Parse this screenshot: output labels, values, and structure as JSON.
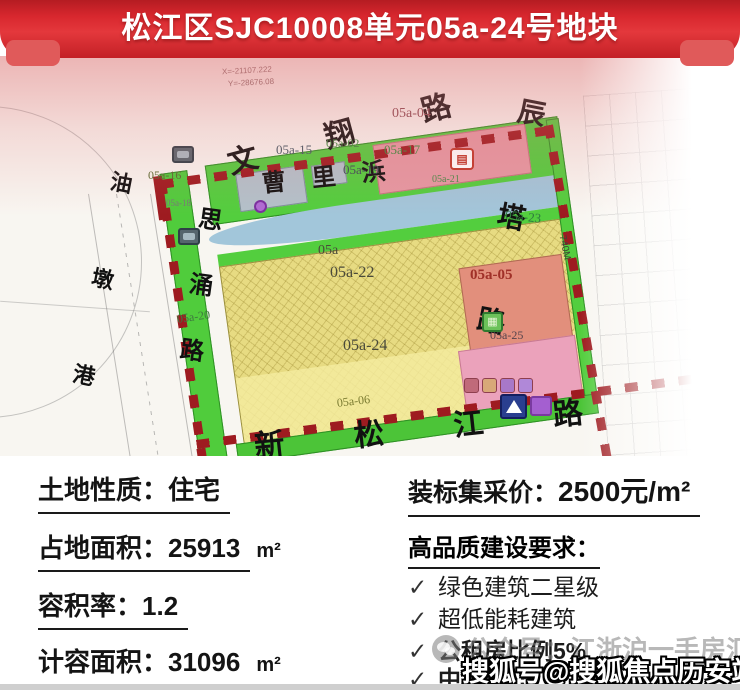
{
  "header": {
    "title": "松江区SJC10008单元05a-24号地块"
  },
  "map": {
    "roads": {
      "top": "文翔路",
      "right": "辰塔路",
      "bottom": "新松江路",
      "left_road": "思涌路"
    },
    "waterways": {
      "left_river": "油墩港",
      "mid_river": "曹里浜"
    },
    "distance_label": "740M",
    "coords": {
      "x": "X=-21107.222",
      "y": "Y=-28676.08"
    },
    "parcels": {
      "p15": "05a-15",
      "p02": "05a-02",
      "p17": "05a-17",
      "p04": "05a-04",
      "p16": "05a-16",
      "p18": "05a-18",
      "p19": "05a-19",
      "p21": "05a-21",
      "p23": "05a-23",
      "p20": "05a-20",
      "pmain": "05a",
      "p22": "05a-22",
      "p24": "05a-24",
      "p05": "05a-05",
      "p25": "05a-25",
      "p06": "05a-06"
    },
    "icons": {
      "school_book": "school-book-icon",
      "kindergarten": "kindergarten-icon",
      "school_triangle": "school-triangle-icon"
    }
  },
  "info": {
    "left": [
      {
        "label": "土地性质：",
        "value": "住宅",
        "unit": ""
      },
      {
        "label": "占地面积：",
        "value": "25913",
        "unit": "m²"
      },
      {
        "label": "容积率：",
        "value": "1.2",
        "unit": ""
      },
      {
        "label": "计容面积：",
        "value": "31096",
        "unit": "m²"
      }
    ],
    "price": {
      "label": "装标集采价：",
      "value": "2500元/m²"
    },
    "requirements": {
      "title": "高品质建设要求：",
      "check": "✓",
      "items": [
        {
          "text": "绿色建筑二星级"
        },
        {
          "text": "超低能耗建筑"
        },
        {
          "text": "公租房比例5%"
        },
        {
          "text": "中小套15"
        }
      ]
    }
  },
  "watermarks": {
    "wechat": "公众号：江浙沪一手房汇总",
    "sohu": "搜狐号@搜狐焦点历安站"
  }
}
